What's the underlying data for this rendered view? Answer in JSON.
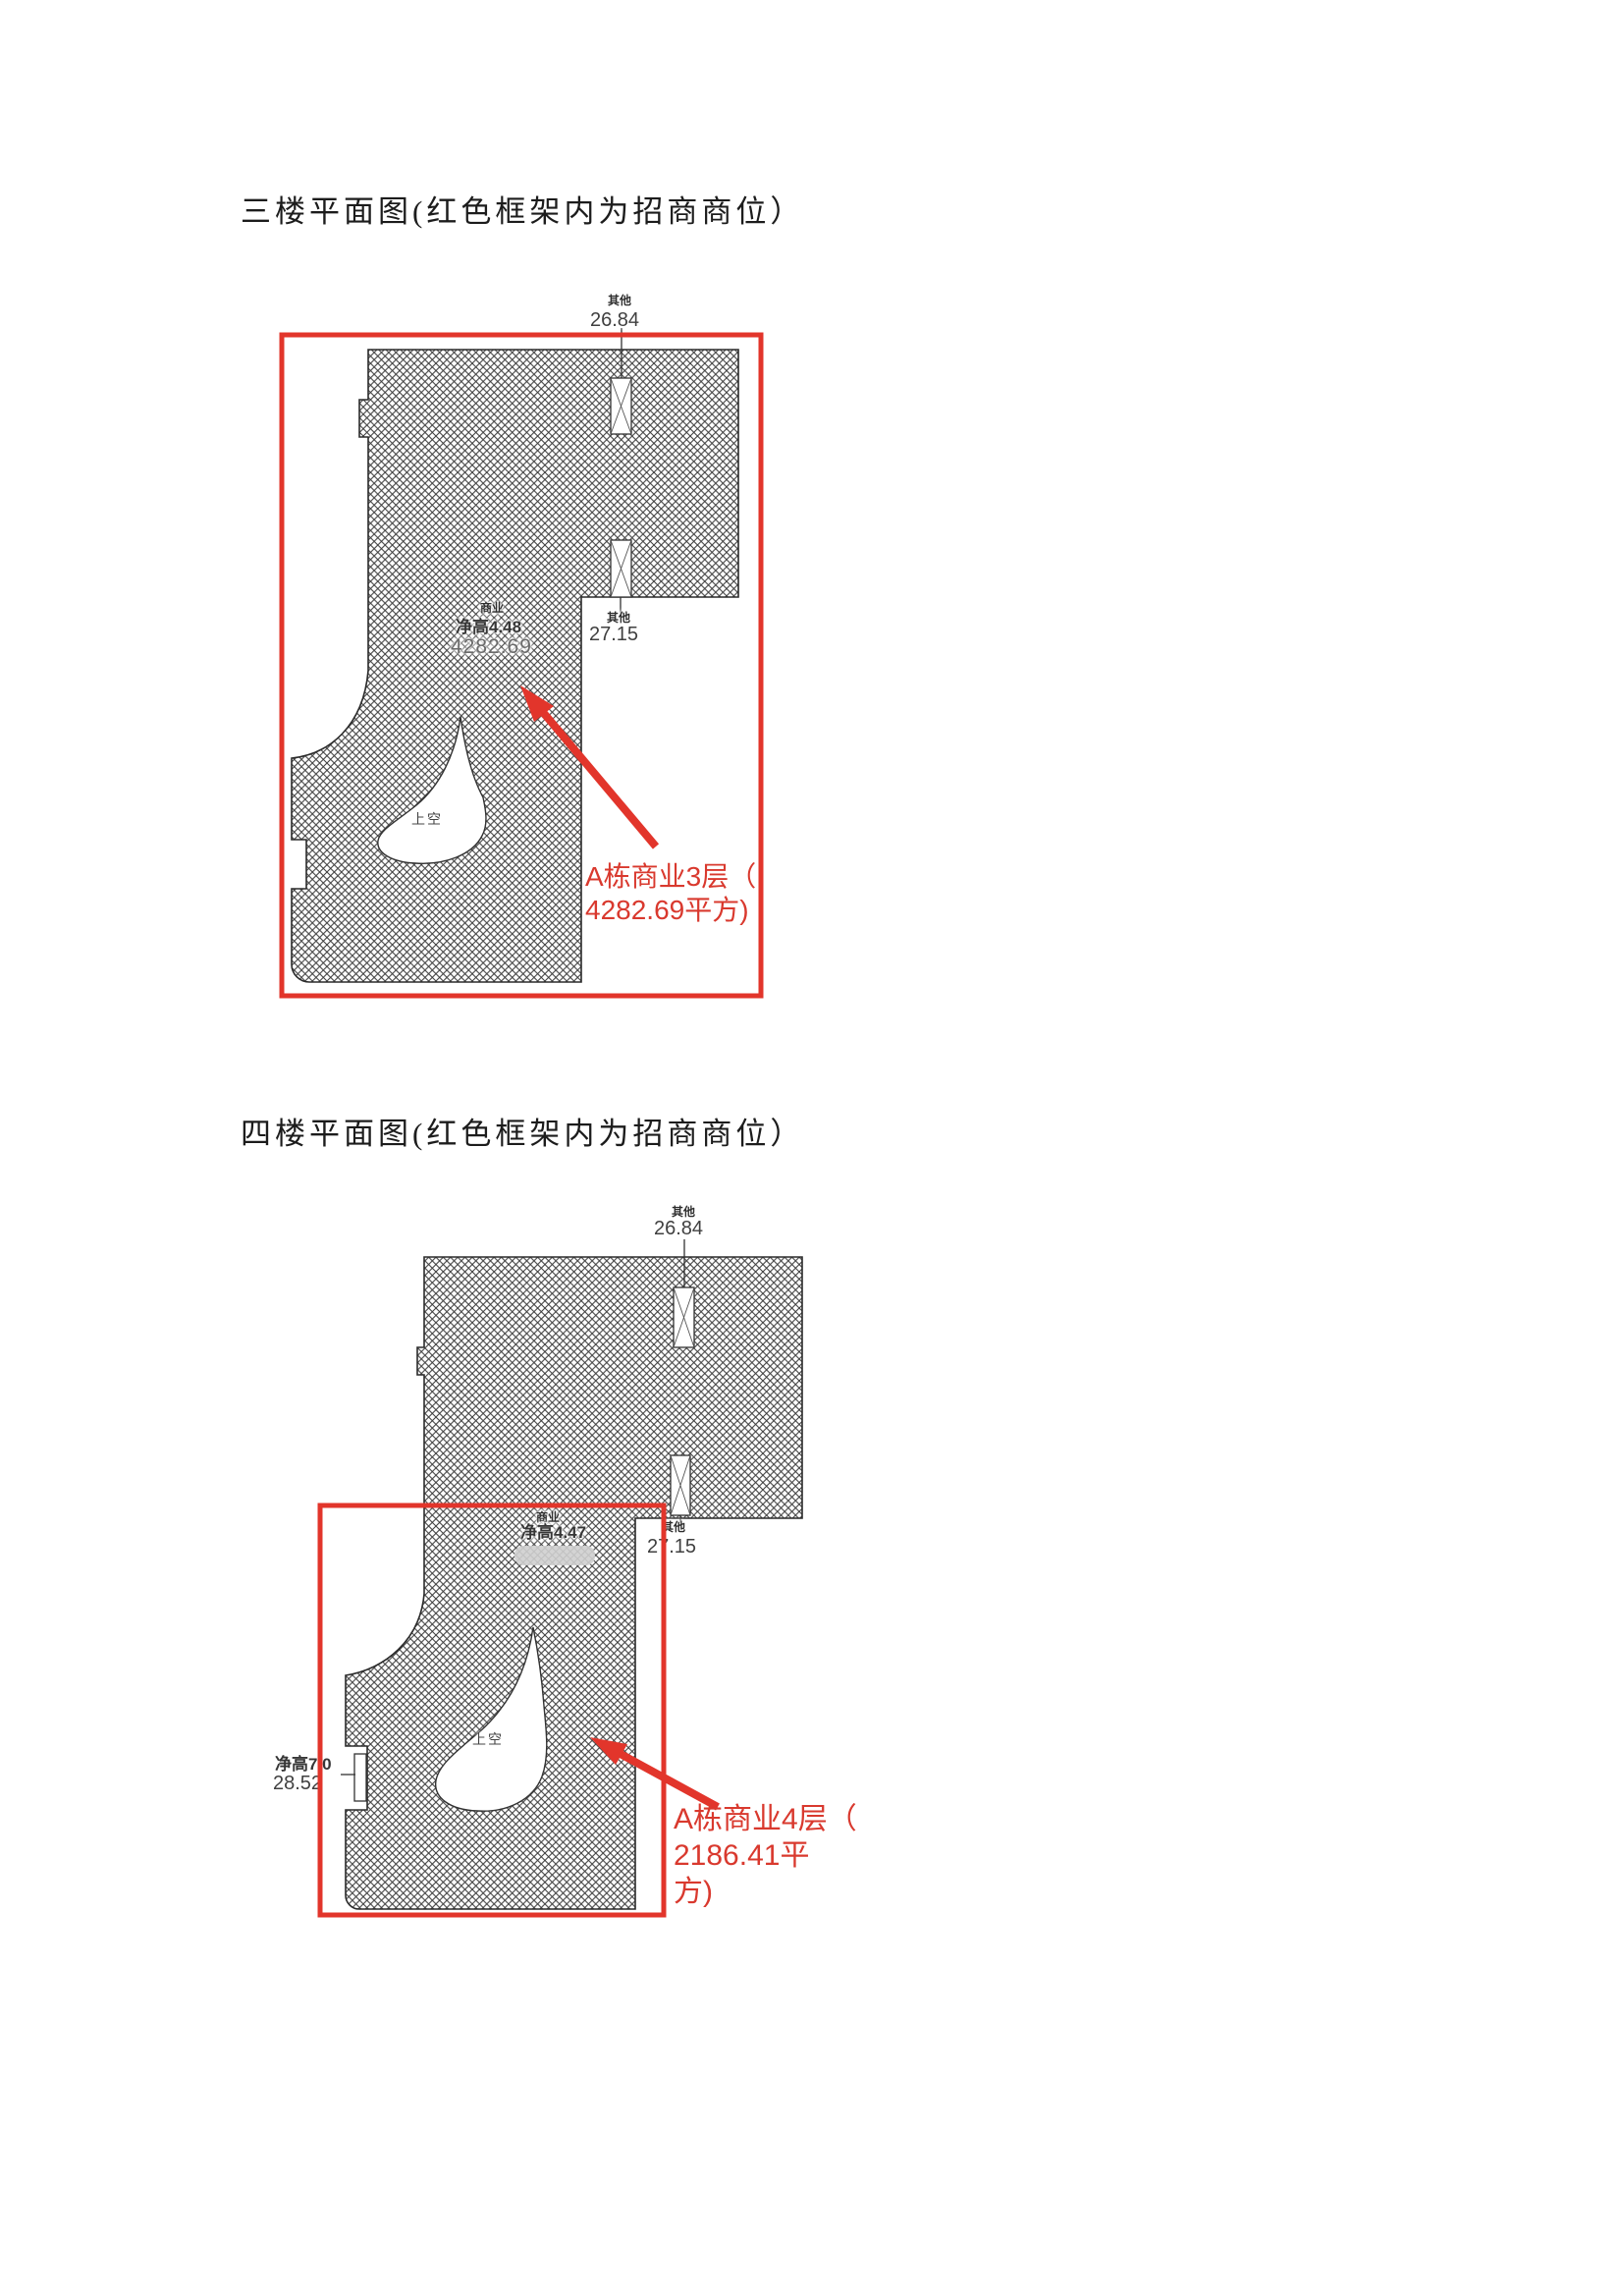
{
  "colors": {
    "accent_red": "#e2352b",
    "callout_red": "#d9392e",
    "hatch_line": "#3d3d3d",
    "label_gray": "#3a3a3a"
  },
  "section3": {
    "title": "三楼平面图(红色框架内为招商商位）",
    "labels": {
      "qita_top": "其他",
      "dim_top": "26.84",
      "shangye": "商业",
      "jinggao": "净高4.48",
      "area": "4282.69",
      "qita_right": "其他",
      "dim_right": "27.15",
      "shangkong": "上空"
    },
    "callout": {
      "line1": "A栋商业3层（",
      "line2": "4282.69平方)"
    }
  },
  "section4": {
    "title": "四楼平面图(红色框架内为招商商位）",
    "labels": {
      "qita_top": "其他",
      "dim_top": "26.84",
      "shangye": "商业",
      "jinggao": "净高4.47",
      "qita_right": "其他",
      "dim_right": "27.15",
      "jinggao_left": "净高7.0",
      "dim_left": "28.52",
      "shangkong": "上空"
    },
    "callout": {
      "line1": "A栋商业4层（",
      "line2": "2186.41平",
      "line3": "方)"
    }
  }
}
